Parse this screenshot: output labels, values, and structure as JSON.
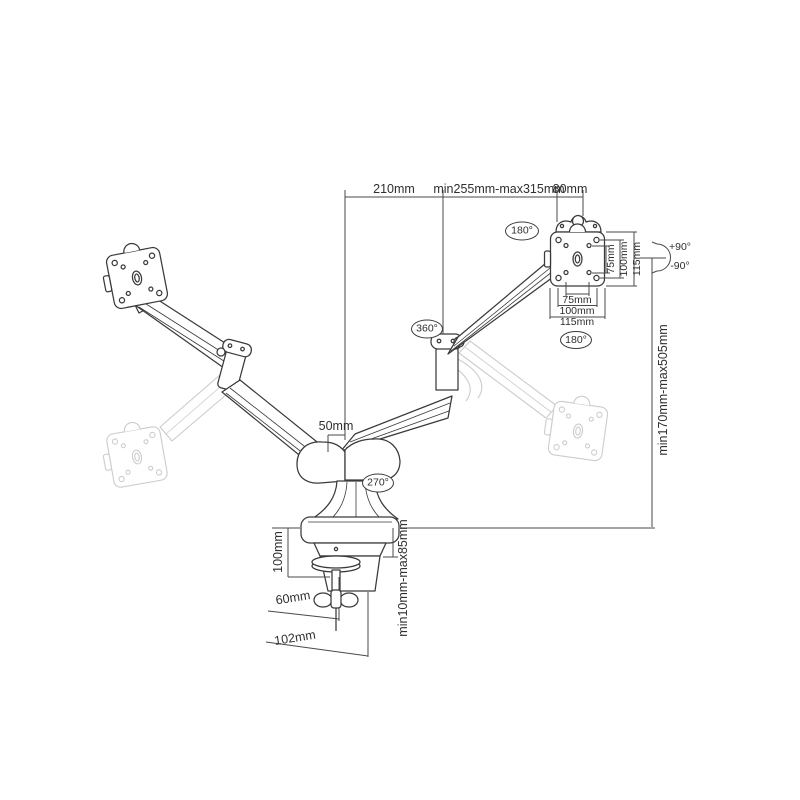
{
  "diagram": {
    "type": "technical-dimension-drawing",
    "subject": "dual-monitor gas-spring desk mount arm",
    "colors": {
      "line": "#3a3a3a",
      "ghost": "#cccccc",
      "dimension": "#4a4a4a",
      "text": "#2f2f2f",
      "background": "#ffffff"
    }
  },
  "labels": {
    "dim_top_left": "210mm",
    "dim_arm_reach": "min255mm-max315mm",
    "dim_top_offset": "80mm",
    "dim_pole_offset": "50mm",
    "dim_height_range": "min170mm-max505mm",
    "dim_clamp_height": "100mm",
    "dim_clamp_range": "min10mm-max85mm",
    "dim_base_depth_inner": "60mm",
    "dim_base_depth_outer": "102mm",
    "vesa_vertical": [
      "75mm",
      "100mm",
      "115mm"
    ],
    "vesa_horizontal": [
      "75mm",
      "100mm",
      "115mm"
    ],
    "rot_top_swivel": "180°",
    "rot_arm_swivel": "360°",
    "rot_base_swivel": "270°",
    "rot_plate": "180°",
    "tilt_up": "+90°",
    "tilt_down": "-90°"
  }
}
